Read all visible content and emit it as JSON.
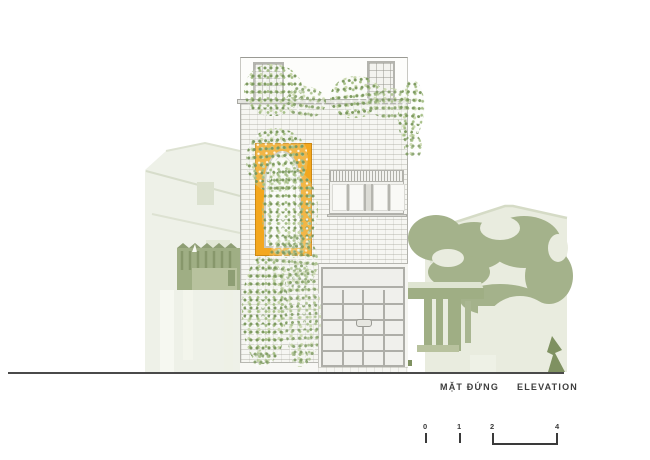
{
  "drawing": {
    "title_vi": "MẶT ĐỨNG",
    "title_en": "ELEVATION"
  },
  "scale_bar": {
    "ticks": [
      "0",
      "1",
      "2",
      "4"
    ]
  },
  "colors": {
    "accent_orange": "#F3A71E",
    "foliage_green": "#7D9A60",
    "background_sage": "#A2B089",
    "background_pale": "#E9ECDF",
    "brick_line_gray": "#A5A59B",
    "ground_line_gray": "#4A4A4A"
  }
}
